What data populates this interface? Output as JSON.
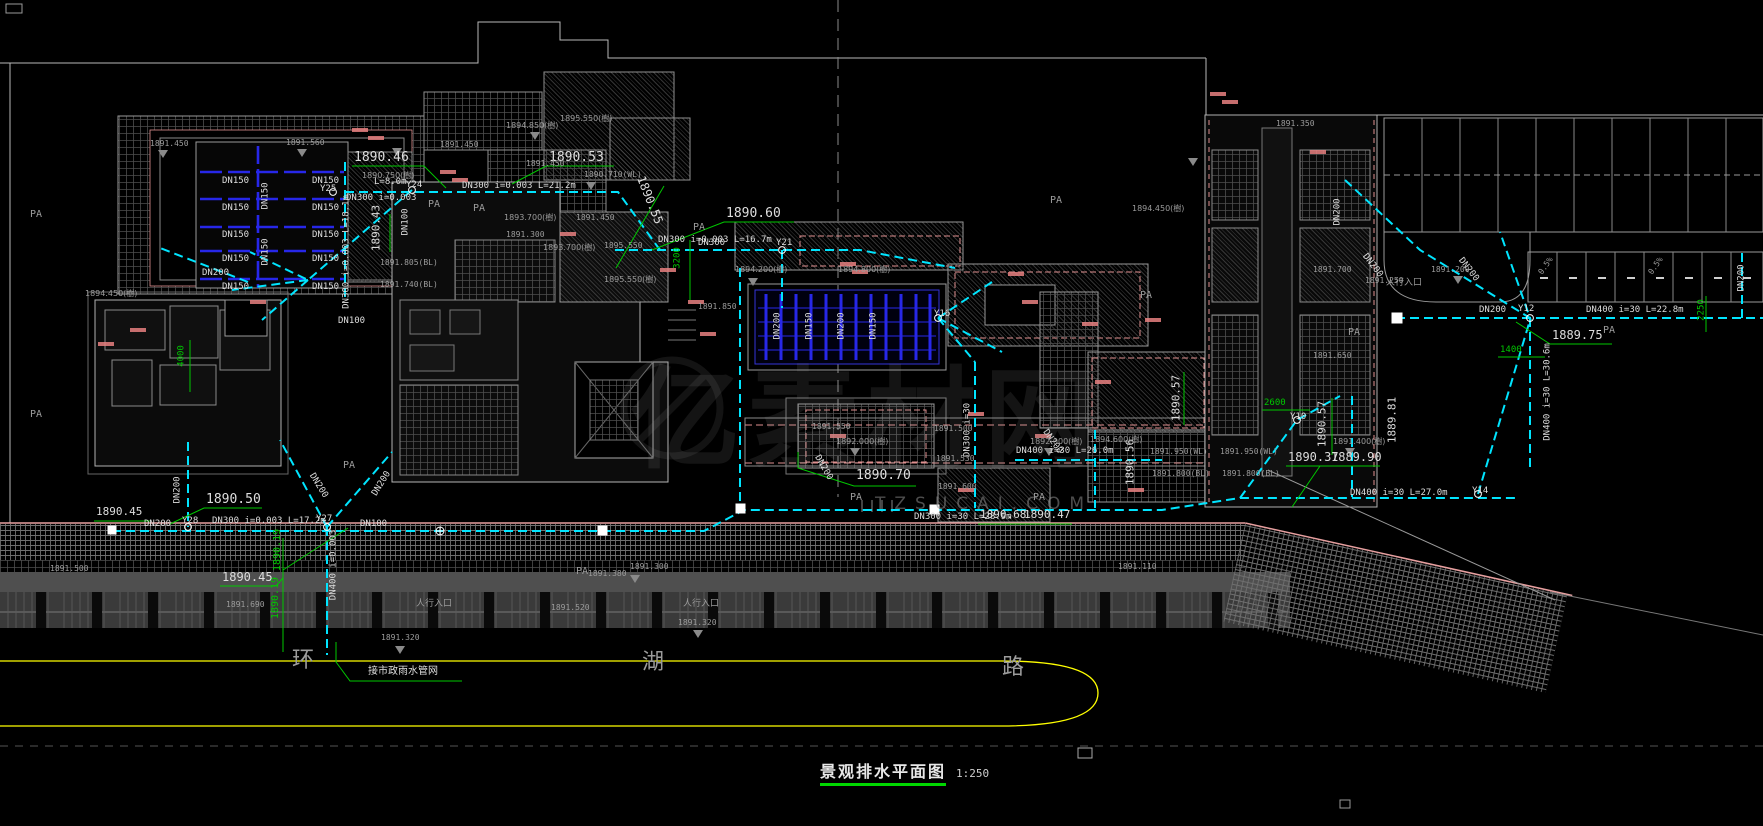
{
  "drawing": {
    "title": "景观排水平面图",
    "scale": "1:250",
    "watermark": {
      "site": "TZSUCAI.COM",
      "logo_text": "亿素材网"
    }
  },
  "labels": [
    {
      "t": "DN300 i=0.003 L=21.2m",
      "x": 462,
      "y": 182
    },
    {
      "t": "DN300 i=0.003 L=16.7m",
      "x": 658,
      "y": 236
    },
    {
      "t": "DN300 i=0.003",
      "x": 346,
      "y": 194
    },
    {
      "t": "L=8.0m",
      "x": 374,
      "y": 178
    },
    {
      "t": "DN300 i=0.003 L=18.1m",
      "x": 347,
      "y": 252,
      "r": -90
    },
    {
      "t": "DN300 i=0.003 L=17.2m",
      "x": 212,
      "y": 517
    },
    {
      "t": "DN300 i=30 L=28.9m",
      "x": 914,
      "y": 513
    },
    {
      "t": "DN400 i=30 L=26.0m",
      "x": 1016,
      "y": 447
    },
    {
      "t": "DN400 i=30 L=27.0m",
      "x": 1350,
      "y": 489
    },
    {
      "t": "DN400 i=30 L=22.8m",
      "x": 1586,
      "y": 306
    },
    {
      "t": "DN400 i=30 L=30.6m",
      "x": 1548,
      "y": 392,
      "r": -90
    },
    {
      "t": "DN400 i=0.003",
      "x": 334,
      "y": 565,
      "r": -90
    },
    {
      "t": "1889.81",
      "x": 1392,
      "y": 420,
      "r": -90,
      "s": 11
    },
    {
      "t": "DN200",
      "x": 1479,
      "y": 306
    },
    {
      "t": "DN200",
      "x": 1742,
      "y": 278,
      "r": -90
    },
    {
      "t": "DN200",
      "x": 1468,
      "y": 270,
      "r": 52
    },
    {
      "t": "DN200",
      "x": 1372,
      "y": 266,
      "r": 52
    },
    {
      "t": "DN100",
      "x": 360,
      "y": 520
    },
    {
      "t": "DN200",
      "x": 144,
      "y": 520
    },
    {
      "t": "DN200",
      "x": 178,
      "y": 490,
      "r": -90
    },
    {
      "t": "DN200",
      "x": 318,
      "y": 486,
      "r": 58
    },
    {
      "t": "DN200",
      "x": 382,
      "y": 484,
      "r": -58
    },
    {
      "t": "DN300",
      "x": 698,
      "y": 239
    },
    {
      "t": "DN200",
      "x": 202,
      "y": 269
    },
    {
      "t": "DN100",
      "x": 338,
      "y": 317
    },
    {
      "t": "DN100",
      "x": 406,
      "y": 222,
      "r": -90
    },
    {
      "t": "DN200",
      "x": 1338,
      "y": 212,
      "r": -90
    },
    {
      "t": "DN300 i=30",
      "x": 968,
      "y": 430,
      "r": -90
    },
    {
      "t": "DN200",
      "x": 823,
      "y": 468,
      "r": 60
    },
    {
      "t": "DN200",
      "x": 1052,
      "y": 442,
      "r": 55
    },
    {
      "t": "Y25",
      "x": 320,
      "y": 185
    },
    {
      "t": "Y24",
      "x": 406,
      "y": 181
    },
    {
      "t": "Y21",
      "x": 776,
      "y": 239
    },
    {
      "t": "Y28",
      "x": 182,
      "y": 517
    },
    {
      "t": "Y27",
      "x": 316,
      "y": 515
    },
    {
      "t": "Y16",
      "x": 934,
      "y": 310
    },
    {
      "t": "Y10",
      "x": 1290,
      "y": 413
    },
    {
      "t": "Y12",
      "x": 1518,
      "y": 305
    },
    {
      "t": "Y14",
      "x": 1472,
      "y": 487
    },
    {
      "t": "DN150",
      "x": 222,
      "y": 177
    },
    {
      "t": "DN150",
      "x": 312,
      "y": 177
    },
    {
      "t": "DN150",
      "x": 222,
      "y": 204
    },
    {
      "t": "DN150",
      "x": 312,
      "y": 204
    },
    {
      "t": "DN150",
      "x": 222,
      "y": 231
    },
    {
      "t": "DN150",
      "x": 312,
      "y": 231
    },
    {
      "t": "DN150",
      "x": 222,
      "y": 255
    },
    {
      "t": "DN150",
      "x": 312,
      "y": 255
    },
    {
      "t": "DN150",
      "x": 222,
      "y": 283
    },
    {
      "t": "DN150",
      "x": 312,
      "y": 283
    },
    {
      "t": "DN150",
      "x": 266,
      "y": 196,
      "r": -90
    },
    {
      "t": "DN150",
      "x": 266,
      "y": 252,
      "r": -90
    },
    {
      "t": "DN200",
      "x": 778,
      "y": 326,
      "r": -90
    },
    {
      "t": "DN150",
      "x": 810,
      "y": 326,
      "r": -90
    },
    {
      "t": "DN200",
      "x": 842,
      "y": 326,
      "r": -90
    },
    {
      "t": "DN150",
      "x": 874,
      "y": 326,
      "r": -90
    },
    {
      "t": "1890.46",
      "x": 354,
      "y": 151,
      "s": 13
    },
    {
      "t": "1890.53",
      "x": 549,
      "y": 151,
      "s": 13
    },
    {
      "t": "1890.55",
      "x": 650,
      "y": 200,
      "s": 12,
      "r": 68
    },
    {
      "t": "1890.60",
      "x": 726,
      "y": 207,
      "s": 13
    },
    {
      "t": "1890.43",
      "x": 376,
      "y": 228,
      "s": 11,
      "r": -90
    },
    {
      "t": "1890.50",
      "x": 206,
      "y": 493,
      "s": 13
    },
    {
      "t": "1890.45",
      "x": 222,
      "y": 571,
      "s": 12
    },
    {
      "t": "1890.45",
      "x": 96,
      "y": 506,
      "s": 11
    },
    {
      "t": "1890.70",
      "x": 856,
      "y": 469,
      "s": 13
    },
    {
      "t": "1890.37",
      "x": 1288,
      "y": 451,
      "s": 12
    },
    {
      "t": "1889.90",
      "x": 1331,
      "y": 451,
      "s": 12
    },
    {
      "t": "1889.75",
      "x": 1552,
      "y": 329,
      "s": 12
    },
    {
      "t": "1890.68",
      "x": 980,
      "y": 509,
      "s": 11
    },
    {
      "t": "1890.47",
      "x": 1024,
      "y": 509,
      "s": 11
    },
    {
      "t": "1890.57",
      "x": 1176,
      "y": 398,
      "s": 11,
      "r": -90
    },
    {
      "t": "1890.57",
      "x": 1322,
      "y": 424,
      "s": 11,
      "r": -90
    },
    {
      "t": "1890.56",
      "x": 1130,
      "y": 462,
      "s": 11,
      "r": -90
    },
    {
      "t": "1890.19",
      "x": 278,
      "y": 550,
      "s": 10,
      "r": -90,
      "c": "g"
    },
    {
      "t": "1890.19",
      "x": 276,
      "y": 598,
      "s": 10,
      "r": -90,
      "c": "g"
    },
    {
      "t": "1891.450",
      "x": 150,
      "y": 140,
      "c": "y",
      "s": 8
    },
    {
      "t": "1891.560",
      "x": 286,
      "y": 139,
      "c": "y",
      "s": 8
    },
    {
      "t": "1891.450",
      "x": 440,
      "y": 141,
      "c": "y",
      "s": 8
    },
    {
      "t": "1894.850(樹)",
      "x": 506,
      "y": 122,
      "c": "y",
      "s": 8
    },
    {
      "t": "1895.550(樹)",
      "x": 560,
      "y": 115,
      "c": "y",
      "s": 8
    },
    {
      "t": "1890.750(樹)",
      "x": 362,
      "y": 172,
      "c": "y",
      "s": 8
    },
    {
      "t": "1891.450",
      "x": 526,
      "y": 160,
      "c": "y",
      "s": 8
    },
    {
      "t": "1890.710(WL)",
      "x": 584,
      "y": 171,
      "c": "y",
      "s": 8
    },
    {
      "t": "1893.700(樹)",
      "x": 504,
      "y": 214,
      "c": "y",
      "s": 8
    },
    {
      "t": "1891.450",
      "x": 576,
      "y": 214,
      "c": "y",
      "s": 8
    },
    {
      "t": "1891.300",
      "x": 506,
      "y": 231,
      "c": "y",
      "s": 8
    },
    {
      "t": "1893.700(樹)",
      "x": 543,
      "y": 244,
      "c": "y",
      "s": 8
    },
    {
      "t": "1895.550",
      "x": 604,
      "y": 242,
      "c": "y",
      "s": 8
    },
    {
      "t": "1895.550(樹)",
      "x": 604,
      "y": 276,
      "c": "y",
      "s": 8
    },
    {
      "t": "1894.200(樹)",
      "x": 735,
      "y": 266,
      "c": "y",
      "s": 8
    },
    {
      "t": "1894.800(樹)",
      "x": 838,
      "y": 266,
      "c": "y",
      "s": 8
    },
    {
      "t": "1891.850",
      "x": 698,
      "y": 303,
      "c": "y",
      "s": 8
    },
    {
      "t": "1894.450(樹)",
      "x": 85,
      "y": 290,
      "c": "y",
      "s": 8
    },
    {
      "t": "1891.805(BL)",
      "x": 380,
      "y": 259,
      "c": "y",
      "s": 8
    },
    {
      "t": "1891.740(BL)",
      "x": 380,
      "y": 281,
      "c": "y",
      "s": 8
    },
    {
      "t": "1891.550",
      "x": 812,
      "y": 423,
      "c": "y",
      "s": 8
    },
    {
      "t": "1891.500",
      "x": 934,
      "y": 425,
      "c": "y",
      "s": 8
    },
    {
      "t": "1892.000(樹)",
      "x": 836,
      "y": 438,
      "c": "y",
      "s": 8
    },
    {
      "t": "1892.000(樹)",
      "x": 1030,
      "y": 438,
      "c": "y",
      "s": 8
    },
    {
      "t": "1891.530",
      "x": 936,
      "y": 455,
      "c": "y",
      "s": 8
    },
    {
      "t": "1891.600",
      "x": 938,
      "y": 483,
      "c": "y",
      "s": 8
    },
    {
      "t": "1894.600(樹)",
      "x": 1090,
      "y": 436,
      "c": "y",
      "s": 8
    },
    {
      "t": "1891.950(WL)",
      "x": 1150,
      "y": 448,
      "c": "y",
      "s": 8
    },
    {
      "t": "1891.800(BL)",
      "x": 1152,
      "y": 470,
      "c": "y",
      "s": 8
    },
    {
      "t": "1891.950(WL)",
      "x": 1220,
      "y": 448,
      "c": "y",
      "s": 8
    },
    {
      "t": "1891.800(BL)",
      "x": 1222,
      "y": 470,
      "c": "y",
      "s": 8
    },
    {
      "t": "1891.400(樹)",
      "x": 1333,
      "y": 438,
      "c": "y",
      "s": 8
    },
    {
      "t": "1891.700",
      "x": 1313,
      "y": 266,
      "c": "y",
      "s": 8
    },
    {
      "t": "1891.250",
      "x": 1365,
      "y": 277,
      "c": "y",
      "s": 8
    },
    {
      "t": "1891.200",
      "x": 1431,
      "y": 266,
      "c": "y",
      "s": 8
    },
    {
      "t": "1891.650",
      "x": 1313,
      "y": 352,
      "c": "y",
      "s": 8
    },
    {
      "t": "1891.350",
      "x": 1276,
      "y": 120,
      "c": "y",
      "s": 8
    },
    {
      "t": "1894.450(樹)",
      "x": 1132,
      "y": 205,
      "c": "y",
      "s": 8
    },
    {
      "t": "1891.690",
      "x": 226,
      "y": 601,
      "c": "y",
      "s": 8
    },
    {
      "t": "1891.520",
      "x": 551,
      "y": 604,
      "c": "y",
      "s": 8
    },
    {
      "t": "1891.380",
      "x": 588,
      "y": 570,
      "c": "y",
      "s": 8
    },
    {
      "t": "1891.320",
      "x": 678,
      "y": 619,
      "c": "y",
      "s": 8
    },
    {
      "t": "1891.320",
      "x": 381,
      "y": 634,
      "c": "y",
      "s": 8
    },
    {
      "t": "1891.110",
      "x": 1118,
      "y": 563,
      "c": "y",
      "s": 8
    },
    {
      "t": "1891.300",
      "x": 630,
      "y": 563,
      "c": "y",
      "s": 8
    },
    {
      "t": "1891.500",
      "x": 50,
      "y": 565,
      "c": "y",
      "s": 8
    },
    {
      "t": "PA",
      "x": 30,
      "y": 210,
      "c": "y",
      "s": 10
    },
    {
      "t": "PA",
      "x": 30,
      "y": 410,
      "c": "y",
      "s": 10
    },
    {
      "t": "PA",
      "x": 428,
      "y": 200,
      "c": "y",
      "s": 10
    },
    {
      "t": "PA",
      "x": 473,
      "y": 204,
      "c": "y",
      "s": 10
    },
    {
      "t": "PA",
      "x": 693,
      "y": 223,
      "c": "y",
      "s": 10
    },
    {
      "t": "PA",
      "x": 1348,
      "y": 328,
      "c": "y",
      "s": 10
    },
    {
      "t": "PA",
      "x": 1603,
      "y": 326,
      "c": "y",
      "s": 10
    },
    {
      "t": "PA",
      "x": 850,
      "y": 493,
      "c": "y",
      "s": 10
    },
    {
      "t": "PA",
      "x": 1033,
      "y": 493,
      "c": "y",
      "s": 10
    },
    {
      "t": "PA",
      "x": 343,
      "y": 461,
      "c": "y",
      "s": 10
    },
    {
      "t": "PA",
      "x": 576,
      "y": 567,
      "c": "y",
      "s": 10
    },
    {
      "t": "PA",
      "x": 1050,
      "y": 196,
      "c": "y",
      "s": 10
    },
    {
      "t": "PA",
      "x": 1140,
      "y": 291,
      "c": "y",
      "s": 10
    },
    {
      "t": "0.5%",
      "x": 1546,
      "y": 266,
      "c": "y",
      "r": -55,
      "s": 8
    },
    {
      "t": "0.5%",
      "x": 1656,
      "y": 266,
      "c": "y",
      "r": -55,
      "s": 8
    },
    {
      "t": "人行入口",
      "x": 416,
      "y": 600,
      "c": "y",
      "s": 9
    },
    {
      "t": "人行入口",
      "x": 683,
      "y": 600,
      "c": "y",
      "s": 9
    },
    {
      "t": "人行入口",
      "x": 1386,
      "y": 279,
      "c": "y",
      "s": 9
    },
    {
      "t": "3200",
      "x": 678,
      "y": 258,
      "c": "g",
      "r": -90,
      "s": 9
    },
    {
      "t": "2600",
      "x": 1264,
      "y": 399,
      "c": "g",
      "s": 9
    },
    {
      "t": "1400",
      "x": 1500,
      "y": 346,
      "c": "g",
      "s": 9
    },
    {
      "t": "2250",
      "x": 1702,
      "y": 310,
      "c": "g",
      "r": -90,
      "s": 9
    },
    {
      "t": "4000",
      "x": 182,
      "y": 356,
      "c": "g",
      "r": -90,
      "s": 9
    },
    {
      "t": "环",
      "x": 292,
      "y": 650,
      "c": "y",
      "s": 22
    },
    {
      "t": "湖",
      "x": 642,
      "y": 652,
      "c": "y",
      "s": 22
    },
    {
      "t": "路",
      "x": 1002,
      "y": 657,
      "c": "y",
      "s": 22
    },
    {
      "t": "接市政雨水管网",
      "x": 368,
      "y": 667,
      "c": "w",
      "s": 10
    }
  ]
}
